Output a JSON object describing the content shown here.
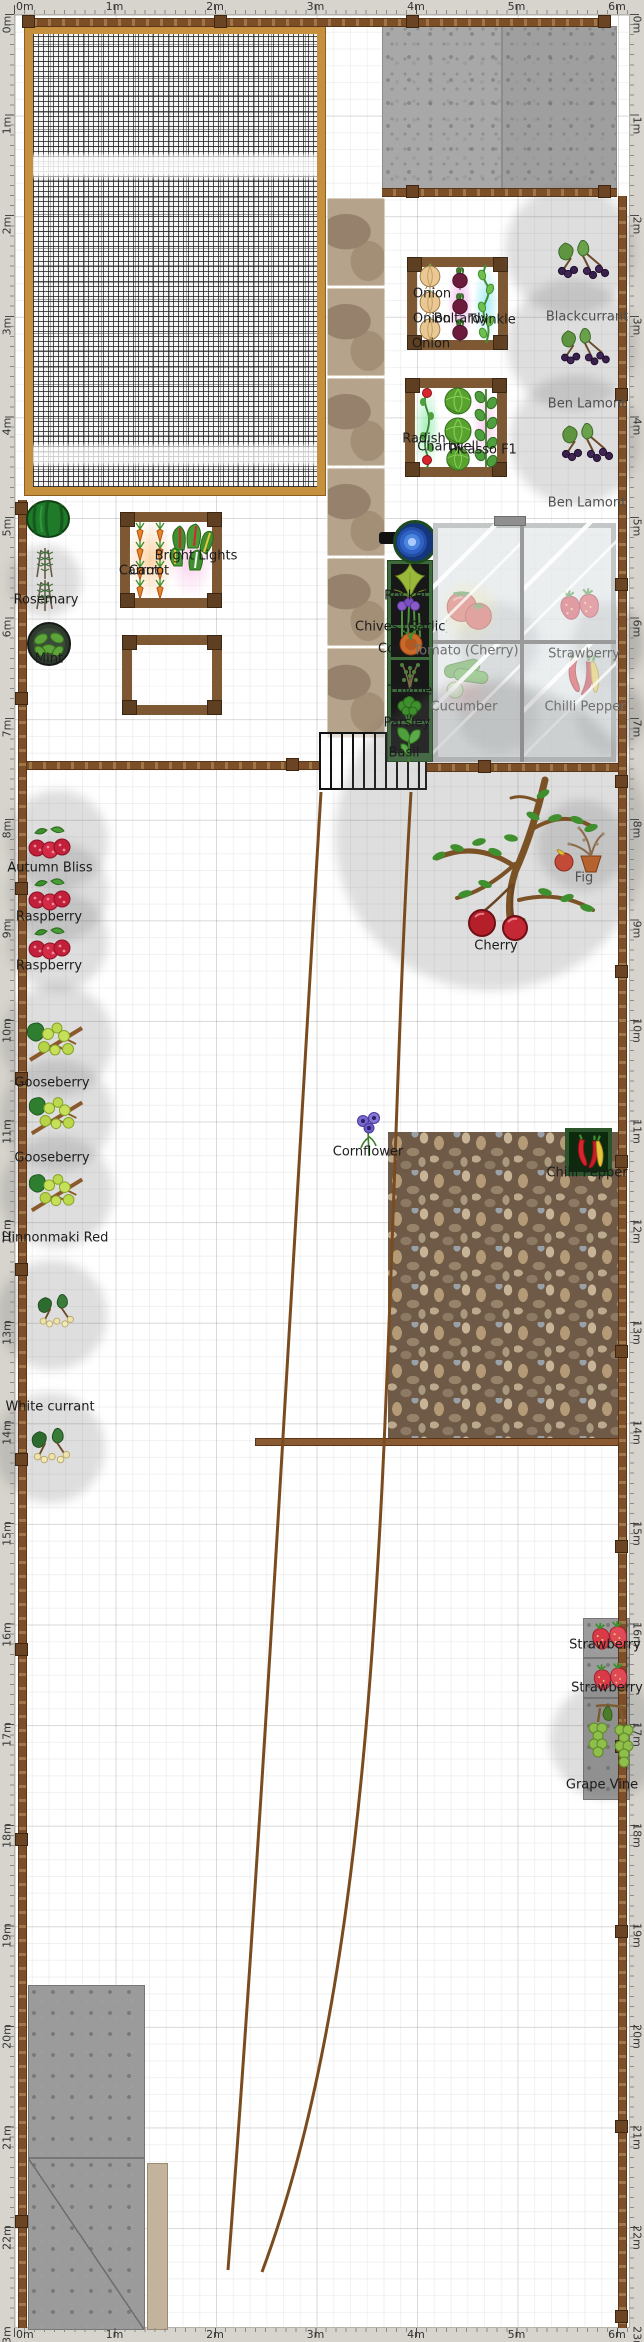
{
  "app": {
    "title": "Garden plan canvas",
    "units": "m"
  },
  "rulers": {
    "top": [
      "0m",
      "1m",
      "2m",
      "3m",
      "4m",
      "5m",
      "6m"
    ],
    "bottom": [
      "0m",
      "1m",
      "2m",
      "3m",
      "4m",
      "5m",
      "6m"
    ],
    "left": [
      "0m",
      "1m",
      "2m",
      "3m",
      "4m",
      "5m",
      "6m",
      "7m",
      "8m",
      "9m",
      "10m",
      "11m",
      "12m",
      "13m",
      "14m",
      "15m",
      "16m",
      "17m",
      "18m",
      "19m",
      "20m",
      "21m",
      "22m",
      "23m"
    ],
    "right": [
      "0m",
      "1m",
      "2m",
      "3m",
      "4m",
      "5m",
      "6m",
      "7m",
      "8m",
      "9m",
      "10m",
      "11m",
      "12m",
      "13m",
      "14m",
      "15m",
      "16m",
      "17m",
      "18m",
      "19m",
      "20m",
      "21m",
      "22m",
      "23m"
    ]
  },
  "labels": [
    {
      "t": "Onion",
      "x": 432,
      "y": 294
    },
    {
      "t": "Onion",
      "x": 432,
      "y": 319
    },
    {
      "t": "Boltardy",
      "x": 461,
      "y": 319
    },
    {
      "t": "Twinkle",
      "x": 492,
      "y": 320
    },
    {
      "t": "Onion",
      "x": 431,
      "y": 344
    },
    {
      "t": "Blackcurrant",
      "x": 587,
      "y": 317,
      "v": "soft"
    },
    {
      "t": "Ben Lamont",
      "x": 587,
      "y": 404,
      "v": "soft"
    },
    {
      "t": "Ben Lamont",
      "x": 587,
      "y": 503,
      "v": "soft"
    },
    {
      "t": "Radish",
      "x": 424,
      "y": 439
    },
    {
      "t": "Chartwell",
      "x": 448,
      "y": 447
    },
    {
      "t": "Picasso F1",
      "x": 483,
      "y": 450
    },
    {
      "t": "Bright Lights",
      "x": 196,
      "y": 556
    },
    {
      "t": "Carrot",
      "x": 139,
      "y": 571
    },
    {
      "t": "Carrot",
      "x": 149,
      "y": 571
    },
    {
      "t": "Rosemary",
      "x": 46,
      "y": 600
    },
    {
      "t": "Mint",
      "x": 49,
      "y": 659
    },
    {
      "t": "Rocket",
      "x": 406,
      "y": 596
    },
    {
      "t": "Chives (Garlic)",
      "x": 355,
      "y": 627,
      "clip": 92
    },
    {
      "t": "Coriander",
      "x": 378,
      "y": 649,
      "clip": 20
    },
    {
      "t": "Tomato (Cherry)",
      "x": 466,
      "y": 651,
      "v": "glass"
    },
    {
      "t": "Strawberry",
      "x": 584,
      "y": 654,
      "v": "glass"
    },
    {
      "t": "Cucumber",
      "x": 464,
      "y": 707,
      "v": "glass"
    },
    {
      "t": "Chilli Pepper",
      "x": 585,
      "y": 707,
      "v": "glass"
    },
    {
      "t": "Thyme",
      "x": 410,
      "y": 691
    },
    {
      "t": "Parsley",
      "x": 407,
      "y": 723
    },
    {
      "t": "Basil",
      "x": 404,
      "y": 753
    },
    {
      "t": "Cherry",
      "x": 496,
      "y": 946
    },
    {
      "t": "Fig",
      "x": 584,
      "y": 878,
      "v": "soft"
    },
    {
      "t": "Autumn Bliss",
      "x": 50,
      "y": 868
    },
    {
      "t": "Raspberry",
      "x": 49,
      "y": 917
    },
    {
      "t": "Raspberry",
      "x": 49,
      "y": 966
    },
    {
      "t": "Gooseberry",
      "x": 52,
      "y": 1083
    },
    {
      "t": "Gooseberry",
      "x": 52,
      "y": 1158
    },
    {
      "t": "Hinnonmaki Red",
      "x": 55,
      "y": 1238
    },
    {
      "t": "Cornflower",
      "x": 368,
      "y": 1152
    },
    {
      "t": "Chilli Pepper",
      "x": 587,
      "y": 1173
    },
    {
      "t": "White currant",
      "x": 50,
      "y": 1407
    },
    {
      "t": "Strawberry",
      "x": 605,
      "y": 1645
    },
    {
      "t": "Strawberry",
      "x": 607,
      "y": 1688
    },
    {
      "t": "Grape Vine",
      "x": 602,
      "y": 1785
    }
  ],
  "icons": [
    "onion-icon",
    "beetroot-icon",
    "pea-vine-icon",
    "radish-vine-icon",
    "cabbage-icon",
    "leaf-column-icon",
    "carrot-icon",
    "chard-icon",
    "rocket-icon",
    "chives-icon",
    "pot-plant-icon",
    "thyme-icon",
    "parsley-icon",
    "basil-icon",
    "tomato-icon",
    "strawberry-icon",
    "cucumber-icon",
    "chilli-icon",
    "blackcurrant-icon",
    "cherry-tree-icon",
    "fig-icon",
    "raspberry-icon",
    "gooseberry-icon",
    "white-currant-icon",
    "cornflower-icon",
    "grape-vine-icon",
    "mint-pot-icon",
    "rosemary-icon",
    "melon-pot-icon",
    "water-butt-icon"
  ],
  "colors": {
    "ruler_bg": "#d7d4cd",
    "fence": "#7d4f28",
    "cage_frame": "#c6913e",
    "bed_frame": "#7d5833",
    "greenhouse_frame": "#9a9a9a",
    "planter_frame": "#3c6b3c",
    "pebble_base": "#6e5a46",
    "slab_gray": "#a8a8a8",
    "label_dark": "#1c1c1c",
    "label_soft": "#4f4f4f",
    "label_glass": "#6f6f6f"
  }
}
